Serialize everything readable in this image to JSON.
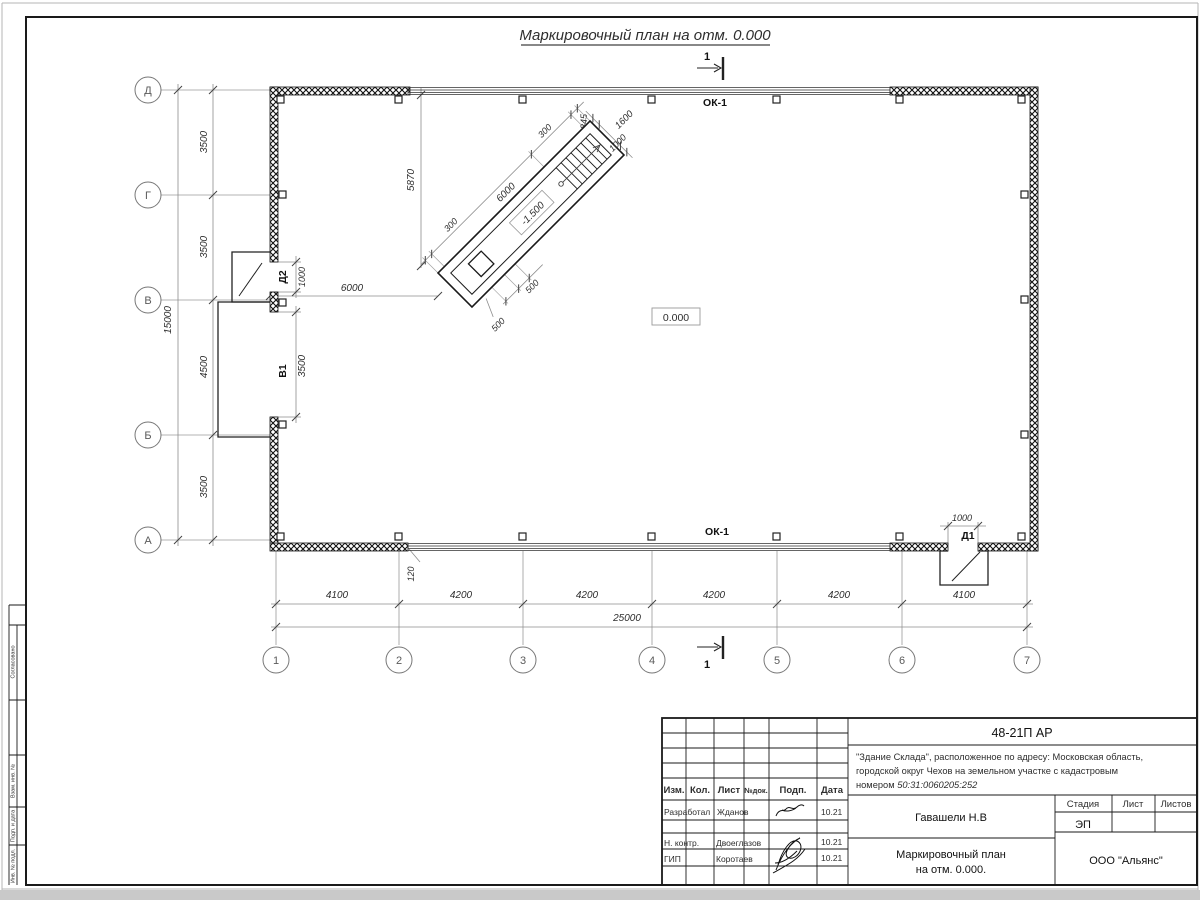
{
  "page": {
    "surround_color": "#c9c9c9"
  },
  "drawing": {
    "title": "Маркировочный план на отм. 0.000",
    "labels": {
      "level_zero": "0.000",
      "ramp_level": "-1.500",
      "window_top": "ОК-1",
      "window_bottom": "ОК-1",
      "door1": "Д1",
      "door2": "Д2",
      "gate": "В1",
      "section": "1"
    },
    "axes": {
      "letters": [
        "Д",
        "Г",
        "В",
        "Б",
        "А"
      ],
      "numbers": [
        "1",
        "2",
        "3",
        "4",
        "5",
        "6",
        "7"
      ]
    },
    "dims": {
      "left_intervals": [
        "3500",
        "3500",
        "4500",
        "3500"
      ],
      "left_total": "15000",
      "bottom_intervals": [
        "4100",
        "4200",
        "4200",
        "4200",
        "4200",
        "4100"
      ],
      "bottom_total": "25000",
      "plan_6000": "6000",
      "plan_5870": "5870",
      "gate_width": "3500",
      "door2_width": "1000",
      "door1_width": "1000",
      "wall_offset": "120",
      "ramp": {
        "r300a": "300",
        "r6000": "6000",
        "r300b": "300",
        "r1845": "1845",
        "r1600": "1600",
        "r1000": "1000",
        "r500a": "500",
        "r500b": "500"
      }
    }
  },
  "title_block": {
    "doc_number": "48-21П АР",
    "project_line1": "\"Здание Склада\", расположенное по адресу: Московская область,",
    "project_line2": "городской округ Чехов на земельном участке с кадастровым",
    "project_line3_prefix": "номером ",
    "cadastral": "50:31:0060205:252",
    "header": {
      "izm": "Изм.",
      "kol": "Кол.",
      "list": "Лист",
      "ndok": "№док.",
      "podp": "Подп.",
      "data": "Дата"
    },
    "rows": [
      {
        "role": "Разработал",
        "name": "Жданов",
        "date": "10.21"
      },
      {
        "role": "Н. контр.",
        "name": "Двоеглазов",
        "date": "10.21"
      },
      {
        "role": "ГИП",
        "name": "Коротаев",
        "date": "10.21"
      }
    ],
    "chief": "Гавашели Н.В",
    "sheet_title_line1": "Маркировочный план",
    "sheet_title_line2": "на отм. 0.000.",
    "stage_label": "Стадия",
    "sheet_label": "Лист",
    "sheets_label": "Листов",
    "stage_value": "ЭП",
    "org": "ООО \"Альянс\""
  },
  "side_stamp": {
    "agreed": "Согласовано",
    "zam": "Взам. инв. №",
    "podp": "Подп. и дата",
    "inv": "Инв. № подл."
  }
}
